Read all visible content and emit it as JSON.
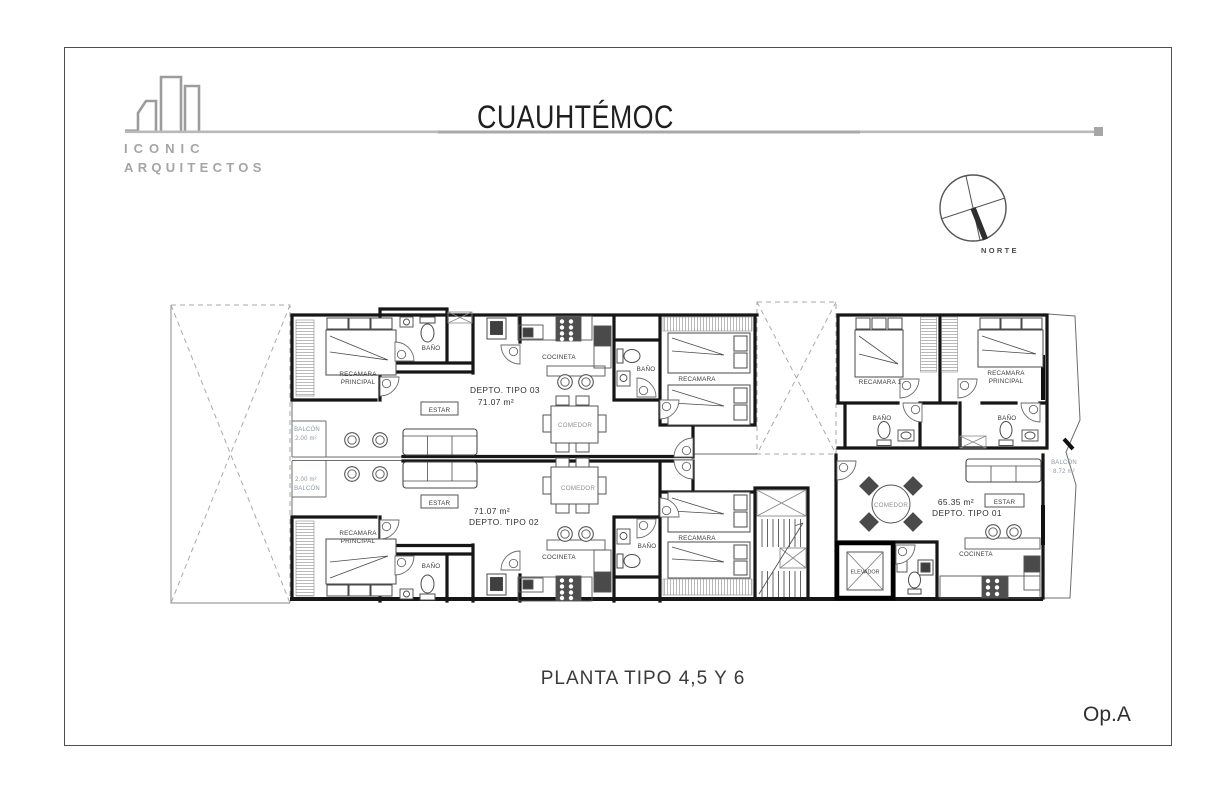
{
  "header": {
    "logo_line1": "ICONIC",
    "logo_line2": "ARQUITECTOS",
    "title": "CUAUHTÉMOC"
  },
  "compass": {
    "label": "NORTE"
  },
  "plan": {
    "units": [
      {
        "name": "DEPTO. TIPO 03",
        "area": "71.07 m²"
      },
      {
        "name": "DEPTO. TIPO 02",
        "area": "71.07 m²"
      },
      {
        "name": "DEPTO. TIPO 01",
        "area": "65.35 m²"
      }
    ],
    "rooms": {
      "recamara": "RECAMARA",
      "recamara_1": "RECAMARA 1",
      "recamara_principal_l1": "RECAMARA",
      "recamara_principal_l2": "PRINCIPAL",
      "bano": "BAÑO",
      "cocineta": "COCINETA",
      "estar": "ESTAR",
      "comedor": "COMEDOR",
      "elevador": "ELEVADOR",
      "balcon": "BALCÓN"
    },
    "areas": {
      "balcon_small": "2.00 m²",
      "balcon_large": "8.72 m²"
    }
  },
  "footer": {
    "plan_title": "PLANTA TIPO 4,5 Y 6",
    "option": "Op.A"
  }
}
